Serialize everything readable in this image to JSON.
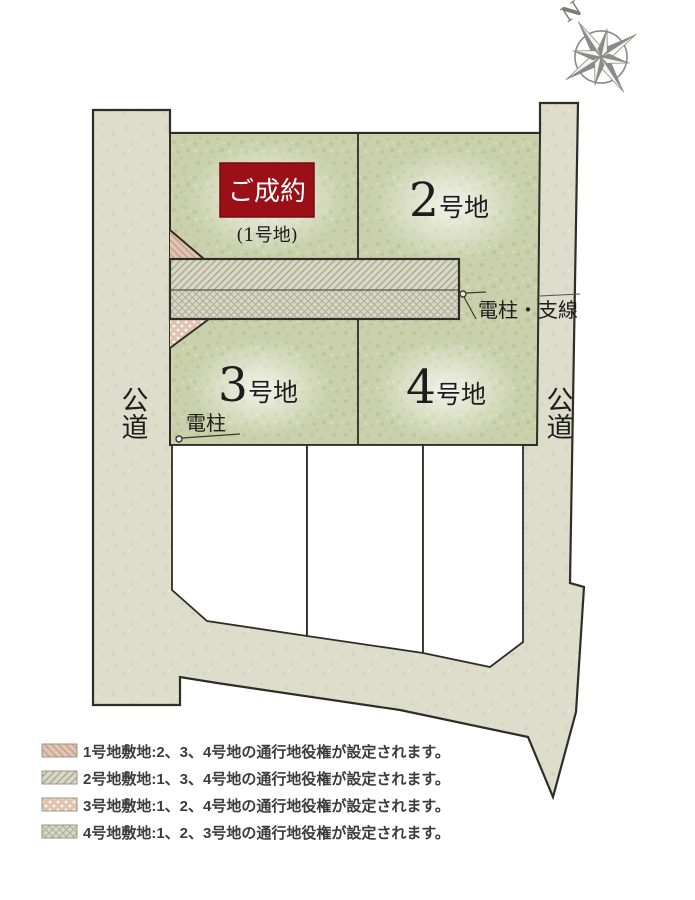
{
  "compass": {
    "label": "N"
  },
  "map": {
    "roads": {
      "left_label": "公道",
      "right_label": "公道"
    },
    "lots": {
      "lot1": {
        "status": "ご成約",
        "name": "(1号地)"
      },
      "lot2": {
        "num": "2",
        "suffix": "号地"
      },
      "lot3": {
        "num": "3",
        "suffix": "号地"
      },
      "lot4": {
        "num": "4",
        "suffix": "号地"
      }
    },
    "annotations": {
      "utility_pole_guywire": "電柱・支線",
      "utility_pole": "電柱"
    }
  },
  "legend": {
    "items": [
      {
        "swatch": "diagonal-hatch-pink",
        "text": "1号地敷地:2、3、4号地の通行地役権が設定されます。"
      },
      {
        "swatch": "diagonal-hatch-green",
        "text": "2号地敷地:1、3、4号地の通行地役権が設定されます。"
      },
      {
        "swatch": "dots-pink",
        "text": "3号地敷地:1、2、4号地の通行地役権が設定されます。"
      },
      {
        "swatch": "crosshatch-green",
        "text": "4号地敷地:1、2、3号地の通行地役権が設定されます。"
      }
    ]
  },
  "colors": {
    "sold_red": "#9b1016",
    "lot_green": "#c9d0ab",
    "road_beige": "#dedcca",
    "outline": "#2e2e26"
  }
}
